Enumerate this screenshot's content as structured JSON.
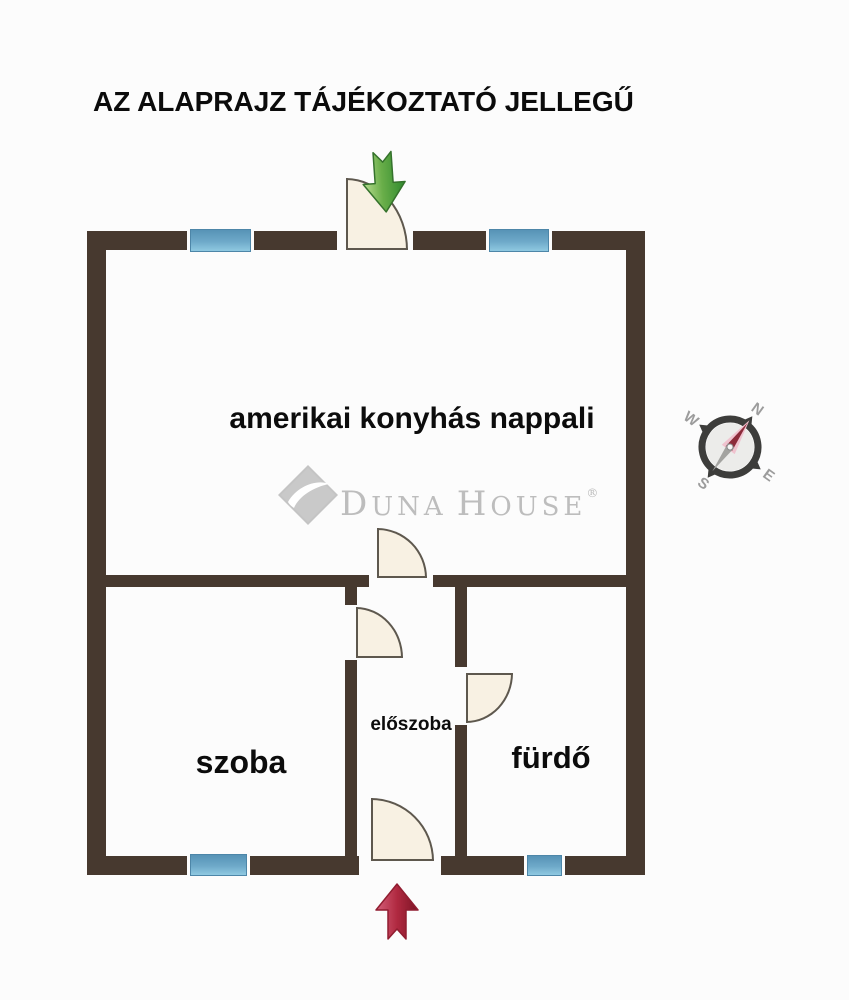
{
  "title": "AZ ALAPRAJZ TÁJÉKOZTATÓ JELLEGŰ",
  "rooms": {
    "living": "amerikai konyhás nappali",
    "bedroom": "szoba",
    "hall": "előszoba",
    "bathroom": "fürdő"
  },
  "watermark": {
    "word1_initial": "D",
    "word1_rest": "UNA",
    "word2_initial": "H",
    "word2_rest": "OUSE",
    "registered": "®"
  },
  "compass": {
    "north": "N",
    "east": "E",
    "south": "S",
    "west": "W"
  },
  "colors": {
    "wall": "#47392f",
    "window_blue": "#5793b6",
    "door_fill": "#f8f1e3",
    "entrance_arrow_green": "#3f9b3a",
    "bottom_arrow_red": "#b52b42",
    "compass_needle": "#8c2b3a",
    "watermark_gray": "#bdbdbd"
  }
}
